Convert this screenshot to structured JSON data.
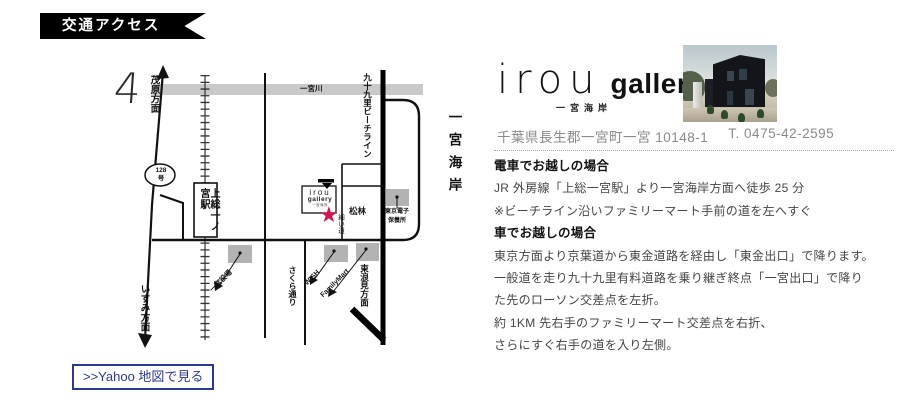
{
  "ribbon": {
    "label": "交通アクセス"
  },
  "map": {
    "compass": "4",
    "star_color": "#d0164e",
    "labels": {
      "mobara": "茂原方面",
      "isumi": "いすみ方面",
      "route128_no": "128",
      "route128_go": "号",
      "station": "上総一ノ宮駅",
      "river": "一宮川",
      "beachline": "九十九里ビーチライン",
      "kaigan": "一宮海岸",
      "matsubayashi": "松林",
      "denshi_1": "東京電子",
      "denshi_2": "保養所",
      "town_hall": "一宮役場",
      "sakura": "さくら通り",
      "wish": "WISH",
      "familymart": "FamilyMart",
      "torami": "東浪見方面",
      "narrow_road": "細い道",
      "logo_1": "irou",
      "logo_2": "gallery",
      "logo_3": "一宮海岸",
      "star": "★"
    }
  },
  "brand": {
    "name_thin": "irou",
    "name_bold": "gallery",
    "subtitle": "一宮海岸"
  },
  "contact": {
    "address": "千葉県長生郡一宮町一宮 10148-1",
    "tel": "T. 0475-42-2595"
  },
  "access": {
    "train_heading": "電車でお越しの場合",
    "train_line_1": "JR 外房線「上総一宮駅」より一宮海岸方面へ徒歩 25 分",
    "train_line_2": "※ビーチライン沿いファミリーマート手前の道を左へすぐ",
    "car_heading": "車でお越しの場合",
    "car_line_1": "東京方面より京葉道から東金道路を経由し「東金出口」で降ります。",
    "car_line_2": "一般道を走り九十九里有料道路を乗り継ぎ終点「一宮出口」で降り",
    "car_line_3": "た先のローソン交差点を左折。",
    "car_line_4": "約 1KM 先右手のファミリーマート交差点を右折、",
    "car_line_5": "さらにすぐ右手の道を入り左側。"
  },
  "yahoo_link": {
    "label": ">>Yahoo 地図で見る",
    "color": "#2b3990"
  }
}
